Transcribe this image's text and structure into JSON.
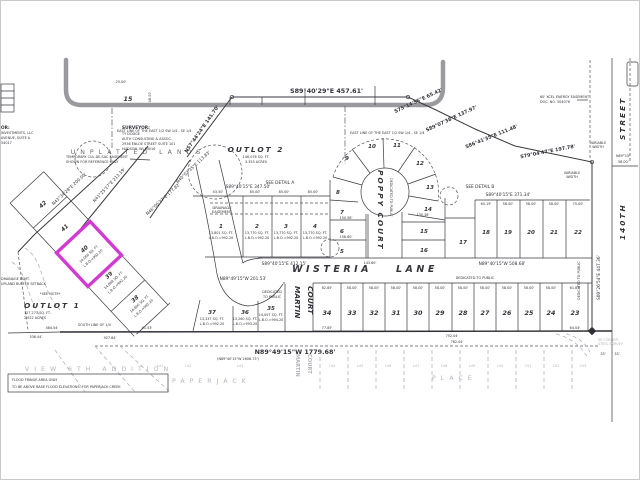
{
  "page": {
    "bg": "#ffffff",
    "frame": "#c9c9c9"
  },
  "highlight": {
    "color": "#d23bd2",
    "lot": "40"
  },
  "owner_block": {
    "heading": "OR:",
    "line1": "INVESTMENTS, LLC",
    "line2": "AVENUE, SUITE A",
    "line3": "54017"
  },
  "surveyor_block": {
    "heading": "SURVEYOR:",
    "line1": "TY DODGE",
    "line2": "AUTH CONSULTING & ASSOC.",
    "line3": "2936 ENLOE STREET SUITE 101",
    "line4": "HUDSON, WI 54016"
  },
  "outlot1": {
    "name": "OUTLOT 1",
    "area": "127,271 SQ. FT.",
    "acres": "2.922 ACRES"
  },
  "outlot2": {
    "name": "OUTLOT 2",
    "area": "146,076 SQ. FT.",
    "acres": "3.353 ACRES"
  },
  "streets": {
    "wisteria": "WISTERIA",
    "lane": "LANE",
    "poppy": "POPPY  COURT",
    "martin": "MARTIN",
    "martin2": "COURT",
    "st140": "140TH",
    "st140b": "STREET"
  },
  "bearings": {
    "top": "S89°40'29\"E  457.61'",
    "b2": "S75°14'55\"E 65.42'",
    "b3": "S89°07'38\"E 137.97'",
    "b4": "S86°41'35\"E 111.48'",
    "b5": "S79°04'47\"E 197.78'",
    "b6": "N57°44'24\"E 141.70'",
    "b7": "N41°25'17\"E 213.19'",
    "b8": "N43°34'28\"E  200.00'",
    "b9": "N46°06'37\"E 177.82'",
    "b10": "N40°02'35\"E 113.83'",
    "east140": "S00°26'54\"E 447.36'",
    "lots1_4": "S89°40'15\"E  347.50'",
    "wisteria": "S89°40'15\"E  412.15'",
    "lots18_22": "S89°40'15\"E  371.34'",
    "lots18_22_s": "N89°40'15\"W  508.68'",
    "lots35_37": "N89°49'15\"W 201.53'",
    "south": "N89°49'15\"W   1779.68'",
    "south_paren": "(N89°40'15\"W 2608.73')",
    "ne_corner": "N89°33'",
    "ne_corner_d": "58.00'"
  },
  "dims": {
    "d2500": "25.00'",
    "d4800": "48.00'",
    "d4350": "43.50'",
    "d8500": "85.00'",
    "d5800": "58.00'",
    "d6019": "60.19'",
    "d7500": "75.00'",
    "d6285": "62.85'",
    "d7785": "77.85'",
    "d6404": "64.04'",
    "d6187": "61.87'",
    "d48454": "484.54'",
    "d53644": "536.44'",
    "d92764": "927.64'",
    "d4153": "41.53'",
    "d75204": "752.04'",
    "d78204": "782.04'",
    "d15058": "150.58'",
    "d15860": "158.60'",
    "d14360": "143.60'",
    "d13038": "130.38'",
    "d33": "33'"
  },
  "notes": {
    "temp1": "TEMPORARY CUL-DE-SAC EASEMENT",
    "temp2": "SHOWN FOR REFERENCE ONLY",
    "unplatted": "UNPLATTED LANDS",
    "eastline": "EAST LINE OF THE EAST 1/2 SW 1/4 - SE 1/4",
    "xcel1": "60' XCEL ENERGY EASEMENT",
    "xcel2": "DOC. NO. 504076",
    "var1": "VARIABLE",
    "var2": "WIDTH",
    "dedicated": "DEDICATED  TO  PUBLIC",
    "dedicated1": "DEDICATED",
    "dedicated2": "TO PUBLIC",
    "detailA": "SEE DETAIL A",
    "detailB": "SEE DETAIL B",
    "drain1": "DRAINAGE",
    "drain2": "EASEMENT",
    "drainleft1": "DRAINAGE ESMT.",
    "drainleft2": "UPLAND BUFFER SETBACK",
    "seenote": "*SEE NOTE*",
    "southline": "SOUTH LINE OF 1/4",
    "flood1": "FLOOD FRINGE AREA ONLY",
    "flood2": "TO BE ABOVE BASE FLOOD ELEVATIONS. FOR PAPERJACK CREEK",
    "corner1": "SE CORNER",
    "corner2": "STEEL SURVEY"
  },
  "lots": {
    "1": {
      "n": "1",
      "a": "13,801 SQ. FT.",
      "l": "L.B.O.=992.20"
    },
    "2": {
      "n": "2",
      "a": "13,770 SQ. FT.",
      "l": "L.B.O.=992.20"
    },
    "3": {
      "n": "3",
      "a": "13,770 SQ. FT.",
      "l": "L.B.O.=992.20"
    },
    "4": {
      "n": "4",
      "a": "13,770 SQ. FT.",
      "l": "L.B.O.=992.20"
    },
    "5": {
      "n": "5"
    },
    "6": {
      "n": "6"
    },
    "7": {
      "n": "7"
    },
    "8": {
      "n": "8"
    },
    "9": {
      "n": "9"
    },
    "10": {
      "n": "10"
    },
    "11": {
      "n": "11"
    },
    "12": {
      "n": "12"
    },
    "13": {
      "n": "13"
    },
    "14": {
      "n": "14"
    },
    "15": {
      "n": "15"
    },
    "16": {
      "n": "16"
    },
    "17": {
      "n": "17"
    },
    "18": {
      "n": "18"
    },
    "19": {
      "n": "19"
    },
    "20": {
      "n": "20"
    },
    "21": {
      "n": "21"
    },
    "22": {
      "n": "22"
    },
    "23": {
      "n": "23"
    },
    "24": {
      "n": "24"
    },
    "25": {
      "n": "25"
    },
    "26": {
      "n": "26"
    },
    "27": {
      "n": "27"
    },
    "28": {
      "n": "28"
    },
    "29": {
      "n": "29"
    },
    "30": {
      "n": "30"
    },
    "31": {
      "n": "31"
    },
    "32": {
      "n": "32"
    },
    "33": {
      "n": "33"
    },
    "34": {
      "n": "34"
    },
    "35": {
      "n": "35",
      "a": "14,057 SQ. FT.",
      "l": "L.B.O.=994.20"
    },
    "36": {
      "n": "36",
      "a": "13,260 SQ. FT.",
      "l": "L.B.O.=993.20"
    },
    "37": {
      "n": "37",
      "a": "13,337 SQ. FT.",
      "l": "L.B.O.=992.20"
    },
    "38": {
      "n": "38",
      "a": "14,800 SQ. FT.",
      "l": "L.B.O.=992.20"
    },
    "39": {
      "n": "39",
      "a": "14,868 SQ. FT.",
      "l": "L.B.O.=992.20"
    },
    "40": {
      "n": "40",
      "a": "14,066 SQ. FT.",
      "l": "L.B.O.=992.20"
    },
    "41": {
      "n": "41"
    },
    "42": {
      "n": "42"
    }
  },
  "adjacent": {
    "lot15": "15",
    "view": "VIEW 6TH ADDITION",
    "paperjack": "PAPERJACK",
    "place": "PLACE",
    "martin1": "MARTIN",
    "martin2": "COURT",
    "numbers": [
      "141",
      "142",
      "143",
      "144",
      "145",
      "146",
      "147",
      "148",
      "149",
      "150",
      "151",
      "152",
      "153"
    ]
  }
}
